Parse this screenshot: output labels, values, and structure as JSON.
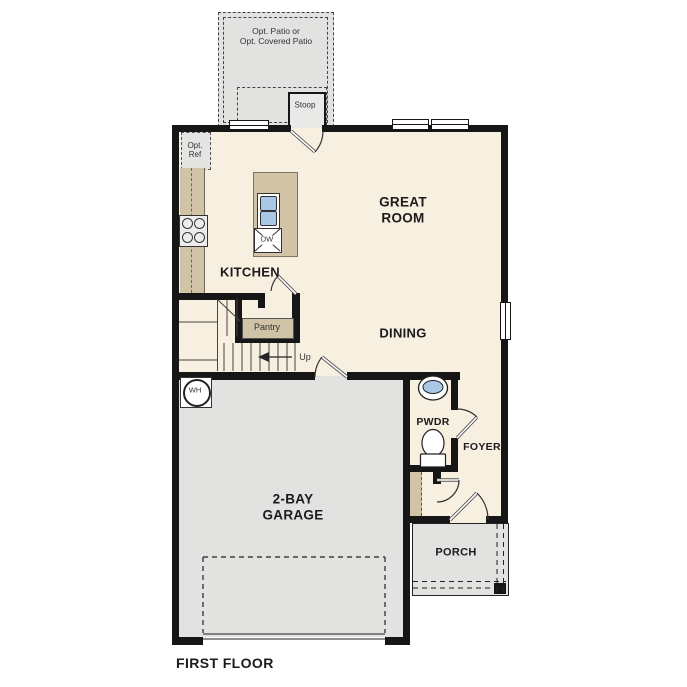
{
  "title": "First floor plan",
  "colors": {
    "floor": "#f7efe0",
    "tan": "#d1c3a6",
    "exterior": "#e2e2e0",
    "stoop": "#e9e9e7",
    "wall": "#161616",
    "sink": "#a9c8e6",
    "line": "#333333",
    "text": "#1b1b1b"
  },
  "labels": {
    "patio": "Opt. Patio or\nOpt. Covered Patio",
    "stoop": "Stoop",
    "opt_ref": "Opt.\nRef",
    "kitchen": "KITCHEN",
    "great_room": "GREAT\nROOM",
    "dining": "DINING",
    "pantry": "Pantry",
    "up": "Up",
    "dw": "DW",
    "wh": "WH",
    "pwdr": "PWDR",
    "foyer": "FOYER",
    "garage": "2-BAY\nGARAGE",
    "porch": "PORCH",
    "first_floor": "FIRST FLOOR"
  }
}
